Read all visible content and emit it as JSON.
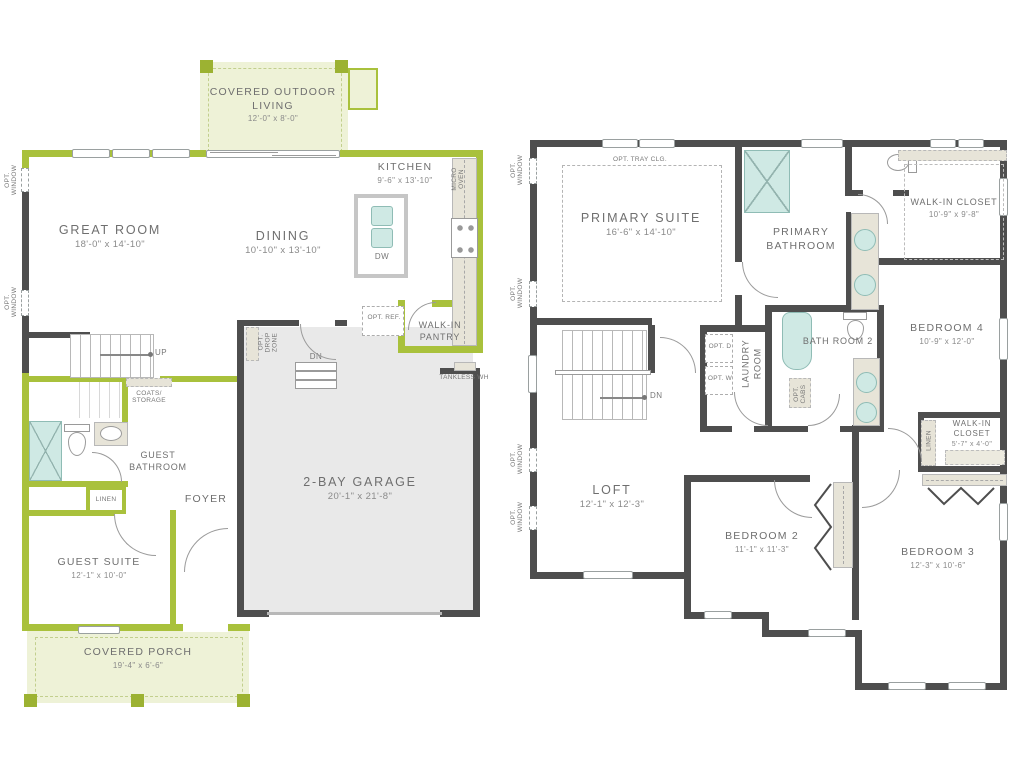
{
  "title": "Two-story home floor plan",
  "colors": {
    "wall_green": "#a9c13c",
    "wall_dark": "#4e4e4e",
    "covered_area_fill": "#eef2d7",
    "garage_fill": "#e9e9e9",
    "fixture_teal": "#cfe9e4",
    "counter_beige": "#e7e4d8",
    "label_text": "#6f6f6f"
  },
  "floor1": {
    "outdoor_living": {
      "name": "COVERED OUTDOOR LIVING",
      "dims": "12'-0\" x 8'-0\""
    },
    "great_room": {
      "name": "GREAT ROOM",
      "dims": "18'-0\" x 14'-10\""
    },
    "dining": {
      "name": "DINING",
      "dims": "10'-10\" x 13'-10\""
    },
    "kitchen": {
      "name": "KITCHEN",
      "dims": "9'-6\" x 13'-10\""
    },
    "micro_oven": "MICRO OVEN",
    "island_dw": "DW",
    "opt_ref": "OPT. REF.",
    "pantry": "WALK-IN PANTRY",
    "tankless_wh": "TANKLESS WH",
    "opt_drop_zone": "OPT. DROP ZONE",
    "garage": {
      "name": "2-BAY GARAGE",
      "dims": "20'-1\" x 21'-8\""
    },
    "stairs_up": "UP",
    "stairs_dn": "DN",
    "coats_storage": "COATS/ STORAGE",
    "guest_bathroom": "GUEST BATHROOM",
    "linen": "LINEN",
    "foyer": "FOYER",
    "guest_suite": {
      "name": "GUEST SUITE",
      "dims": "12'-1\" x 10'-0\""
    },
    "covered_porch": {
      "name": "COVERED PORCH",
      "dims": "19'-4\" x 6'-6\""
    },
    "opt_window": "OPT. WINDOW"
  },
  "floor2": {
    "opt_tray_clg": "OPT. TRAY CLG.",
    "primary_suite": {
      "name": "PRIMARY SUITE",
      "dims": "16'-6\" x 14'-10\""
    },
    "primary_bathroom": "PRIMARY BATHROOM",
    "walk_in_closet_1": {
      "name": "WALK-IN CLOSET",
      "dims": "10'-9\" x 9'-8\""
    },
    "bedroom4": {
      "name": "BEDROOM 4",
      "dims": "10'-9\" x 12'-0\""
    },
    "bath_room_2": "BATH ROOM 2",
    "laundry_room": "LAUNDRY ROOM",
    "opt_d": "OPT. D",
    "opt_w": "OPT. W",
    "opt_cabs": "OPT. CABS",
    "stairs_dn": "DN",
    "loft": {
      "name": "LOFT",
      "dims": "12'-1\" x 12'-3\""
    },
    "bedroom2": {
      "name": "BEDROOM 2",
      "dims": "11'-1\" x 11'-3\""
    },
    "bedroom3": {
      "name": "BEDROOM 3",
      "dims": "12'-3\" x 10'-6\""
    },
    "walk_in_closet_2": {
      "name": "WALK-IN CLOSET",
      "dims": "5'-7\" x 4'-0\""
    },
    "linen": "LINEN",
    "opt_window": "OPT. WINDOW"
  }
}
